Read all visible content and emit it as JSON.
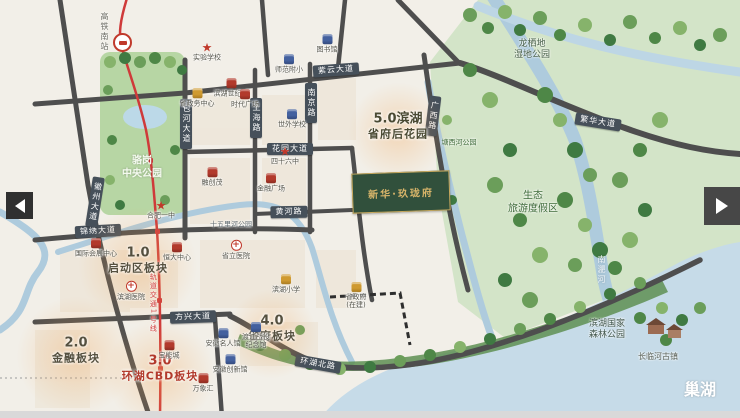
{
  "meta": {
    "title": "滨湖新区区位示意图",
    "lake_name": "巢湖"
  },
  "nav": {
    "left": "previous-image",
    "right": "next-image"
  },
  "project": {
    "name": "新华·玖珑府",
    "x": 352,
    "y": 172,
    "w": 96,
    "h": 38,
    "bg": "#31503c",
    "fg": "#d9b56a"
  },
  "colors": {
    "road": "#4e4e4e",
    "water": "#aecbdd",
    "eco": "#d3e4c8",
    "lake": "#c6dbe8",
    "metro": "#cf3a3a",
    "sign_bg": "#46505a",
    "plate_red": "#b23a2c"
  },
  "metro": {
    "line_label": "轨道交通1号线",
    "station_label": "高铁南站"
  },
  "signs": [
    {
      "text": "紫云大道",
      "x": 336,
      "y": 70,
      "rot": -4,
      "vertical": false
    },
    {
      "text": "繁华大道",
      "x": 598,
      "y": 122,
      "rot": 9,
      "vertical": false
    },
    {
      "text": "花园大道",
      "x": 290,
      "y": 149,
      "rot": 0,
      "vertical": false
    },
    {
      "text": "黄河路",
      "x": 289,
      "y": 212,
      "rot": -1,
      "vertical": false
    },
    {
      "text": "锦绣大道",
      "x": 98,
      "y": 231,
      "rot": -3,
      "vertical": false
    },
    {
      "text": "方兴大道",
      "x": 193,
      "y": 317,
      "rot": -2,
      "vertical": false
    },
    {
      "text": "环湖北路",
      "x": 318,
      "y": 364,
      "rot": 10,
      "vertical": false
    },
    {
      "text": "包河大道",
      "x": 186,
      "y": 124,
      "rot": 0,
      "vertical": true
    },
    {
      "text": "上海路",
      "x": 256,
      "y": 118,
      "rot": 0,
      "vertical": true
    },
    {
      "text": "南京路",
      "x": 311,
      "y": 103,
      "rot": 0,
      "vertical": true
    },
    {
      "text": "广西路",
      "x": 433,
      "y": 116,
      "rot": 7,
      "vertical": true
    },
    {
      "text": "徽州大道",
      "x": 95,
      "y": 202,
      "rot": 9,
      "vertical": true
    }
  ],
  "plates": [
    {
      "num": "1.0",
      "name": "启动区板块",
      "x": 138,
      "y": 260,
      "color": "#55503f",
      "glow": 120
    },
    {
      "num": "2.0",
      "name": "金融板块",
      "x": 76,
      "y": 350,
      "color": "#55503f",
      "glow": 120
    },
    {
      "num": "3.0",
      "name": "环湖CBD板块",
      "x": 160,
      "y": 368,
      "color": "#b23a2c",
      "glow": 110
    },
    {
      "num": "4.0",
      "name": "省府板块",
      "x": 272,
      "y": 328,
      "color": "#55503f",
      "glow": 90
    },
    {
      "num": "5.0滨湖",
      "name": "省府后花园",
      "x": 398,
      "y": 126,
      "color": "#4a4a33",
      "glow": 100
    }
  ],
  "labels": [
    {
      "text": "骆岗\n中央公园",
      "x": 142,
      "y": 168,
      "size": 10,
      "color": "#f4f9ef",
      "bold": true,
      "vertical": false
    },
    {
      "text": "龙栖地\n湿地公园",
      "x": 532,
      "y": 50,
      "size": 9,
      "color": "#49604a",
      "bold": false,
      "vertical": false
    },
    {
      "text": "生态\n旅游度假区",
      "x": 533,
      "y": 203,
      "size": 10,
      "color": "#3f6b3a",
      "bold": false,
      "vertical": false
    },
    {
      "text": "滨湖国家\n森林公园",
      "x": 607,
      "y": 330,
      "size": 9,
      "color": "#41564b",
      "bold": false,
      "vertical": false
    },
    {
      "text": "长临河古镇",
      "x": 658,
      "y": 357,
      "size": 8,
      "color": "#5b6258",
      "bold": false,
      "vertical": false
    },
    {
      "text": "巢湖",
      "x": 700,
      "y": 390,
      "size": 16,
      "color": "#ffffff",
      "bold": true,
      "vertical": false
    },
    {
      "text": "南淝河",
      "x": 601,
      "y": 270,
      "size": 8,
      "color": "#f2f7fa",
      "bold": false,
      "vertical": true
    },
    {
      "text": "塘西河公园",
      "x": 459,
      "y": 143,
      "size": 7,
      "color": "#3f6b3a",
      "bold": false,
      "vertical": false
    },
    {
      "text": "十五里河公园",
      "x": 231,
      "y": 225,
      "size": 7,
      "color": "#5f6a70",
      "bold": false,
      "vertical": false
    },
    {
      "text": "轨道交通1号线",
      "x": 153,
      "y": 303,
      "size": 7,
      "color": "#cf3a3a",
      "bold": false,
      "vertical": true
    },
    {
      "text": "高铁南站",
      "x": 104,
      "y": 32,
      "size": 8,
      "color": "#6a6a62",
      "bold": false,
      "vertical": true
    }
  ],
  "pois": [
    {
      "type": "star",
      "x": 207,
      "y": 52,
      "label": "实验学校"
    },
    {
      "type": "gold",
      "x": 197,
      "y": 98,
      "label": "省政务中心"
    },
    {
      "type": "red",
      "x": 231,
      "y": 88,
      "label": "滨湖世纪城"
    },
    {
      "type": "blue",
      "x": 289,
      "y": 64,
      "label": "师范附小"
    },
    {
      "type": "red",
      "x": 245,
      "y": 99,
      "label": "时代广场"
    },
    {
      "type": "blue",
      "x": 292,
      "y": 119,
      "label": "世外学校"
    },
    {
      "type": "blue",
      "x": 327,
      "y": 44,
      "label": "图书馆"
    },
    {
      "type": "star",
      "x": 285,
      "y": 156,
      "label": "四十六中"
    },
    {
      "type": "red",
      "x": 271,
      "y": 183,
      "label": "金融广场"
    },
    {
      "type": "star",
      "x": 161,
      "y": 210,
      "label": "合肥一中"
    },
    {
      "type": "red",
      "x": 212,
      "y": 177,
      "label": "融创茂"
    },
    {
      "type": "red",
      "x": 96,
      "y": 248,
      "label": "国际会展中心"
    },
    {
      "type": "cross",
      "x": 236,
      "y": 250,
      "label": "省立医院"
    },
    {
      "type": "cross",
      "x": 131,
      "y": 291,
      "label": "滨湖医院"
    },
    {
      "type": "red",
      "x": 177,
      "y": 252,
      "label": "恒大中心"
    },
    {
      "type": "gold",
      "x": 356,
      "y": 296,
      "label": "省政府\n(在建)"
    },
    {
      "type": "gold",
      "x": 286,
      "y": 284,
      "label": "滨湖小学"
    },
    {
      "type": "blue",
      "x": 223,
      "y": 338,
      "label": "安徽名人馆"
    },
    {
      "type": "blue",
      "x": 256,
      "y": 336,
      "label": "渡江战役\n纪念馆"
    },
    {
      "type": "blue",
      "x": 230,
      "y": 364,
      "label": "安徽创新馆"
    },
    {
      "type": "red",
      "x": 169,
      "y": 350,
      "label": "宝能城"
    },
    {
      "type": "red",
      "x": 203,
      "y": 383,
      "label": "万象汇"
    }
  ]
}
